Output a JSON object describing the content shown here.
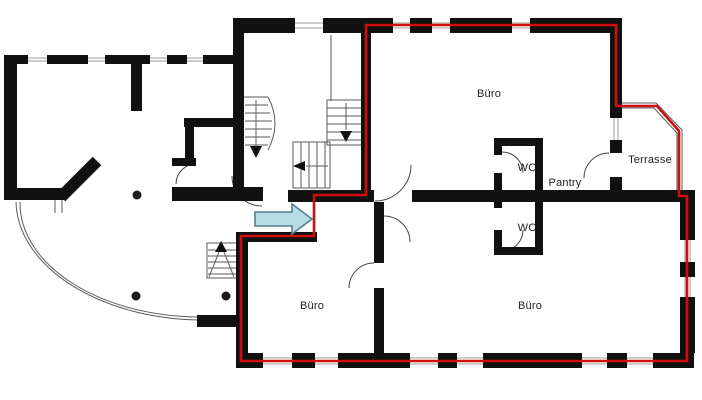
{
  "floorplan": {
    "rooms": {
      "buero_top": "Büro",
      "wc_upper": "WC",
      "pantry": "Pantry",
      "terrasse": "Terrasse",
      "wc_lower": "WC",
      "buero_bottom_left": "Büro",
      "buero_bottom_right": "Büro"
    },
    "colors": {
      "background": "#ffffff",
      "wall": "#111111",
      "highlight_red": "#cf0e0e",
      "arrow_fill": "#b8dce4",
      "arrow_border": "#55808d",
      "outline": "#5a5a5a",
      "window_line": "#9a9a9a"
    }
  }
}
